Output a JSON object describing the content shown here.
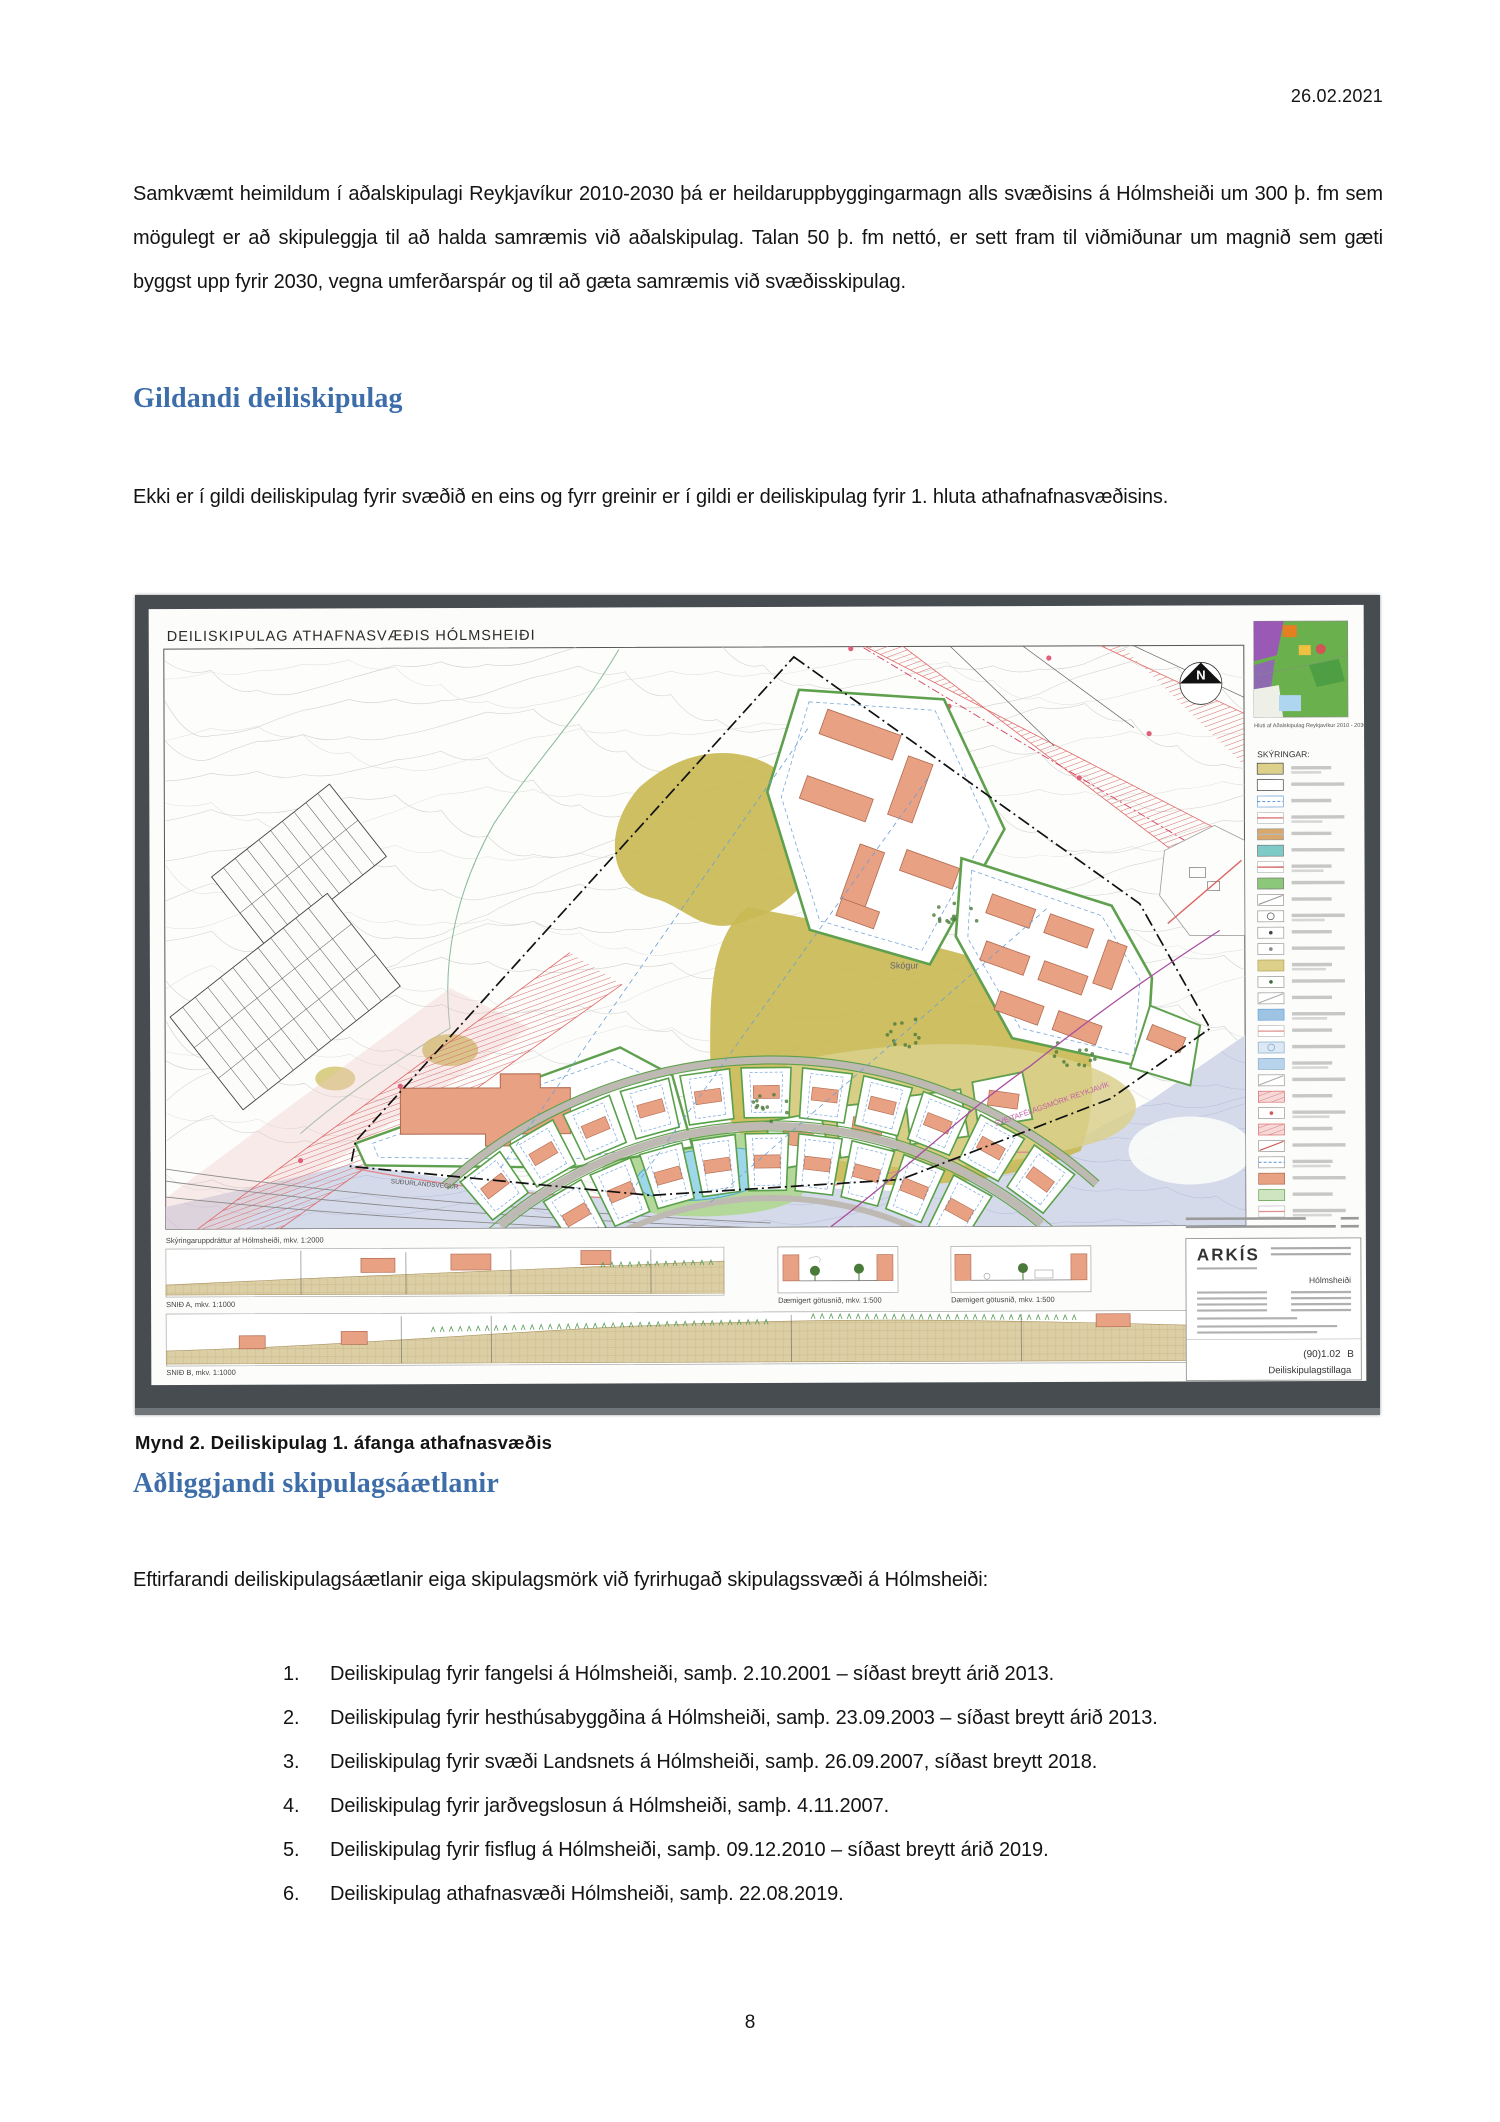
{
  "page": {
    "date": "26.02.2021",
    "page_number": "8"
  },
  "sections": {
    "intro_paragraph": "Samkvæmt heimildum í aðalskipulagi Reykjavíkur 2010-2030 þá er heildaruppbyggingarmagn alls svæðisins á Hólmsheiði um 300 þ. fm sem mögulegt er að skipuleggja til að halda samræmis við aðalskipulag. Talan 50 þ. fm nettó, er sett fram til viðmiðunar um magnið sem gæti byggst upp fyrir 2030, vegna umferðarspár og til að gæta samræmis við svæðisskipulag.",
    "heading1": "Gildandi deiliskipulag",
    "paragraph1": "Ekki er í gildi deiliskipulag fyrir svæðið en eins og fyrr greinir er í gildi er deiliskipulag fyrir 1. hluta athafnafnasvæðisins.",
    "figure_caption": "Mynd 2. Deiliskipulag 1. áfanga athafnasvæðis",
    "heading2": "Aðliggjandi skipulagsáætlanir",
    "paragraph2": "Eftirfarandi deiliskipulagsáætlanir eiga skipulagsmörk við fyrirhugað skipulagssvæði á Hólmsheiði:",
    "list": [
      "Deiliskipulag fyrir fangelsi á Hólmsheiði, samþ. 2.10.2001 – síðast breytt árið 2013.",
      "Deiliskipulag fyrir hesthúsabyggðina á Hólmsheiði, samþ. 23.09.2003 – síðast breytt árið 2013.",
      "Deiliskipulag fyrir svæði Landsnets á Hólmsheiði, samþ. 26.09.2007, síðast breytt 2018.",
      "Deiliskipulag fyrir jarðvegslosun á Hólmsheiði, samþ. 4.11.2007.",
      "Deiliskipulag fyrir fisflug á Hólmsheiði, samþ. 09.12.2010 – síðast breytt árið 2019.",
      "Deiliskipulag athafnasvæði Hólmsheiði, samþ. 22.08.2019."
    ]
  },
  "map": {
    "title": "DEILISKIPULAG ATHAFNASVÆÐIS HÓLMSHEIÐI",
    "north_label": "N",
    "inset_caption": "Hluti af Aðalskipulag Reykjavíkur 2010 - 2030",
    "legend_title": "SKÝRINGAR:",
    "labels": {
      "skogur": "Skógur",
      "municipal_boundary": "SVEITAFÉLAGSMÖRK REYKJAVÍK",
      "road": "SUÐURLANDSVEGUR"
    },
    "annotations": {
      "scale_note": "Skýringaruppdráttur af Hólmsheiði, mkv. 1:2000",
      "section_a": "SNIÐ A, mkv. 1:1000",
      "section_b": "SNIÐ B, mkv. 1:1000",
      "street_section_1": "Dæmigert götusnið, mkv. 1:500",
      "street_section_2": "Dæmigert götusnið, mkv. 1:500"
    },
    "title_block": {
      "firm": "ARKÍS",
      "project": "Hólmsheiði",
      "sheet": "(90)1.02",
      "revision": "B",
      "doc_type": "Deiliskipulagstillaga"
    },
    "colors": {
      "development_area": "#c9ba55",
      "building": "#e8a183",
      "plot_border": "#5fa04e",
      "hatch_red": "#d96b6b",
      "pond": "#9ed7e9",
      "floodplain": "#d5daea",
      "boundary_purple": "#a84f9e",
      "heading_blue": "#3d6ea9"
    },
    "legend_swatches": [
      {
        "f": "#ddd08a",
        "b": "#444",
        "m": ""
      },
      {
        "f": "#ffffff",
        "b": "#444",
        "m": ""
      },
      {
        "f": "#ffffff",
        "b": "#6aa0d8",
        "m": "dash",
        "c": "#6aa0d8"
      },
      {
        "f": "#ffffff",
        "b": "#bbb",
        "m": "line",
        "c": "#d96b6b"
      },
      {
        "f": "#d9a86a",
        "b": "#999",
        "m": "line",
        "c": "#b8b8b8"
      },
      {
        "f": "#7ecac8",
        "b": "#777",
        "m": ""
      },
      {
        "f": "#ffffff",
        "b": "#bbb",
        "m": "line",
        "c": "#d05858"
      },
      {
        "f": "#8cc87a",
        "b": "#777",
        "m": ""
      },
      {
        "f": "#ffffff",
        "b": "#999",
        "m": "diag",
        "c": "#999999"
      },
      {
        "f": "#ffffff",
        "b": "#999",
        "m": "circle",
        "c": "#666666"
      },
      {
        "f": "#ffffff",
        "b": "#999",
        "m": "dot",
        "c": "#444444"
      },
      {
        "f": "#ffffff",
        "b": "#999",
        "m": "dot",
        "c": "#888888"
      },
      {
        "f": "#ddd08a",
        "b": "#b0a35a",
        "m": ""
      },
      {
        "f": "#ffffff",
        "b": "#999",
        "m": "dot",
        "c": "#3a6a3a"
      },
      {
        "f": "#ffffff",
        "b": "#999",
        "m": "diag",
        "c": "#aaaaaa"
      },
      {
        "f": "#9ec4e4",
        "b": "#6aa0d8",
        "m": ""
      },
      {
        "f": "#ffffff",
        "b": "#bbb",
        "m": "line",
        "c": "#e09090"
      },
      {
        "f": "#dce8f4",
        "b": "#88aacc",
        "m": "circle",
        "c": "#88aacc"
      },
      {
        "f": "#b8d4ec",
        "b": "#88aacc",
        "m": ""
      },
      {
        "f": "#ffffff",
        "b": "#999",
        "m": "diag",
        "c": "#aaaaaa"
      },
      {
        "f": "#f6d8d8",
        "b": "#d96b6b",
        "m": "hatch",
        "c": "#d96b6b"
      },
      {
        "f": "#ffffff",
        "b": "#999",
        "m": "dot",
        "c": "#d05858"
      },
      {
        "f": "#f6d8d8",
        "b": "#d96b6b",
        "m": "hatch",
        "c": "#d96b6b"
      },
      {
        "f": "#ffffff",
        "b": "#999",
        "m": "diag",
        "c": "#d05858"
      },
      {
        "f": "#ffffff",
        "b": "#999",
        "m": "dash",
        "c": "#6aa0d8"
      },
      {
        "f": "#e8a183",
        "b": "#b06a50",
        "m": ""
      },
      {
        "f": "#cfe4c0",
        "b": "#5fa04e",
        "m": ""
      },
      {
        "f": "#ffffff",
        "b": "#bbb",
        "m": "line",
        "c": "#e09090"
      }
    ]
  }
}
